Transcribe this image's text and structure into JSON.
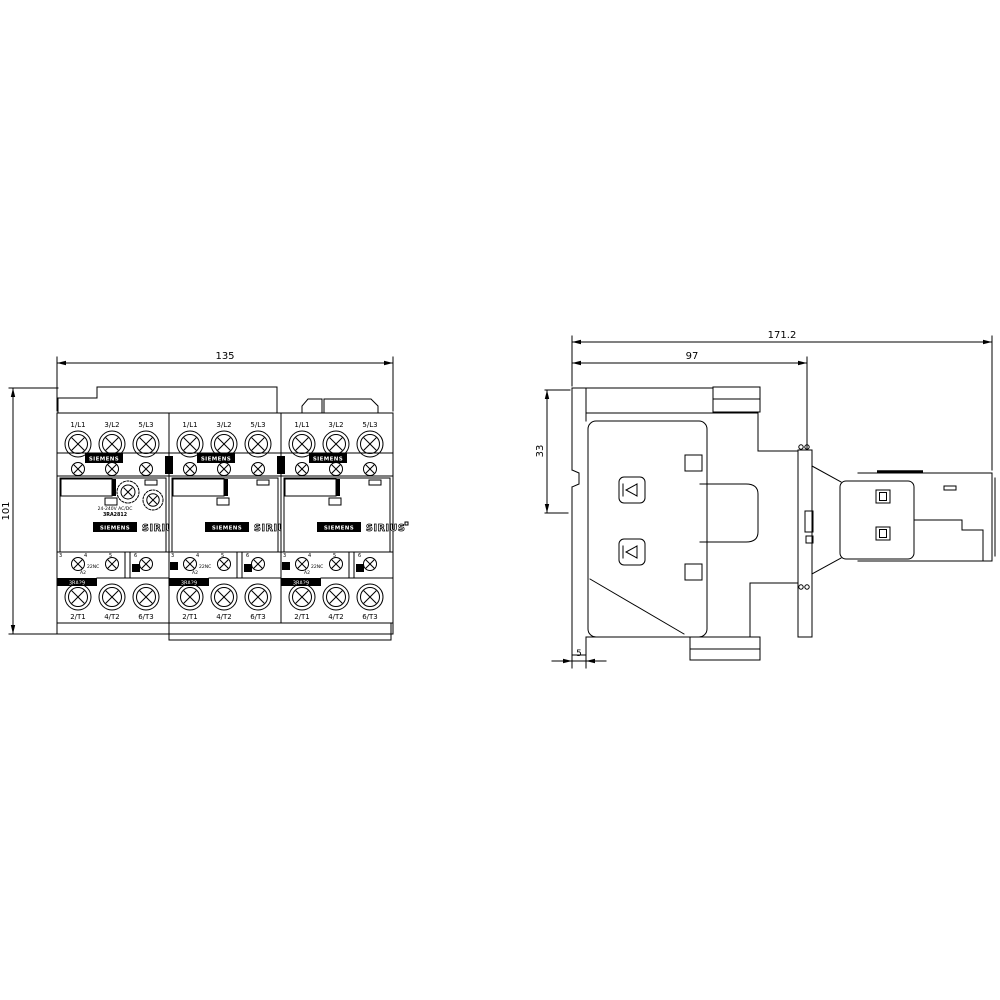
{
  "front_view": {
    "dim_width": "135",
    "dim_height": "101",
    "modules": [
      {
        "top_terminals": [
          "1/L1",
          "3/L2",
          "5/L3"
        ],
        "bottom_terminals": [
          "2/T1",
          "4/T2",
          "6/T3"
        ],
        "header_brand": "SIEMENS",
        "brand": "SIEMENS",
        "series": "SIRIUS",
        "kit_label": "3RA29",
        "coil_terminal": "A2",
        "aux_terminal": "22NC",
        "terminal_numbers": [
          "3",
          "4",
          "5",
          "6"
        ]
      },
      {
        "top_terminals": [
          "1/L1",
          "3/L2",
          "5/L3"
        ],
        "bottom_terminals": [
          "2/T1",
          "4/T2",
          "6/T3"
        ],
        "header_brand": "SIEMENS",
        "brand": "SIEMENS",
        "series": "SIRIUS",
        "kit_label": "3RA29",
        "coil_terminal": "A2",
        "aux_terminal": "22NC",
        "terminal_numbers": [
          "3",
          "4",
          "5",
          "6"
        ]
      },
      {
        "top_terminals": [
          "1/L1",
          "3/L2",
          "5/L3"
        ],
        "bottom_terminals": [
          "2/T1",
          "4/T2",
          "6/T3"
        ],
        "header_brand": "SIEMENS",
        "brand": "SIEMENS",
        "series": "SIRIUS",
        "kit_label": "3RA29",
        "coil_terminal": "A2",
        "aux_terminal": "22NC",
        "terminal_numbers": [
          "3",
          "4",
          "5",
          "6"
        ]
      }
    ],
    "function_module": {
      "voltage_range": "24-240V AC/DC",
      "part_number": "3RA2812"
    }
  },
  "side_view": {
    "dim_total_depth": "171.2",
    "dim_base_depth": "97",
    "dim_rail_offset": "33",
    "dim_clip_width": "5"
  },
  "colors": {
    "ink": "#000000",
    "background": "#ffffff"
  }
}
